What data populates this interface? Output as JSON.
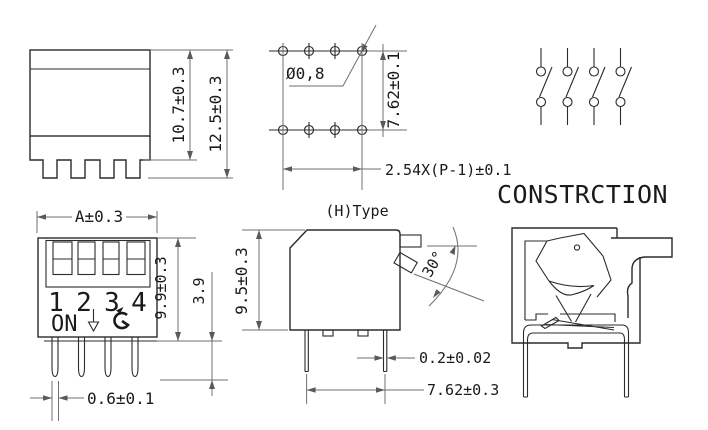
{
  "drawing": {
    "title": "CONSTRCTION",
    "colors": {
      "background": "#ffffff",
      "object_line": "#2b2b2b",
      "dimension_line": "#6f6f6f",
      "text": "#1a1a1a"
    },
    "side_view": {
      "height_inner": "10.7±0.3",
      "height_total": "12.5±0.3"
    },
    "pcb_view": {
      "hole_diameter": "Ø0,8",
      "row_pitch": "7.62±0.1",
      "pin_pitch": "2.54X(P-1)±0.1"
    },
    "schematic_view": {
      "poles": 4
    },
    "front_view": {
      "width": "A±0.3",
      "switch_numbers": [
        "1",
        "2",
        "3",
        "4"
      ],
      "on_label": "ON",
      "body_height": "9.9±0.3",
      "pin_length": "3.9",
      "pin_width": "0.6±0.1"
    },
    "h_type_view": {
      "label": "(H)Type",
      "body_height": "9.5±0.3",
      "lever_angle": "30°",
      "pin_thickness": "0.2±0.02",
      "pin_span": "7.62±0.3"
    }
  }
}
